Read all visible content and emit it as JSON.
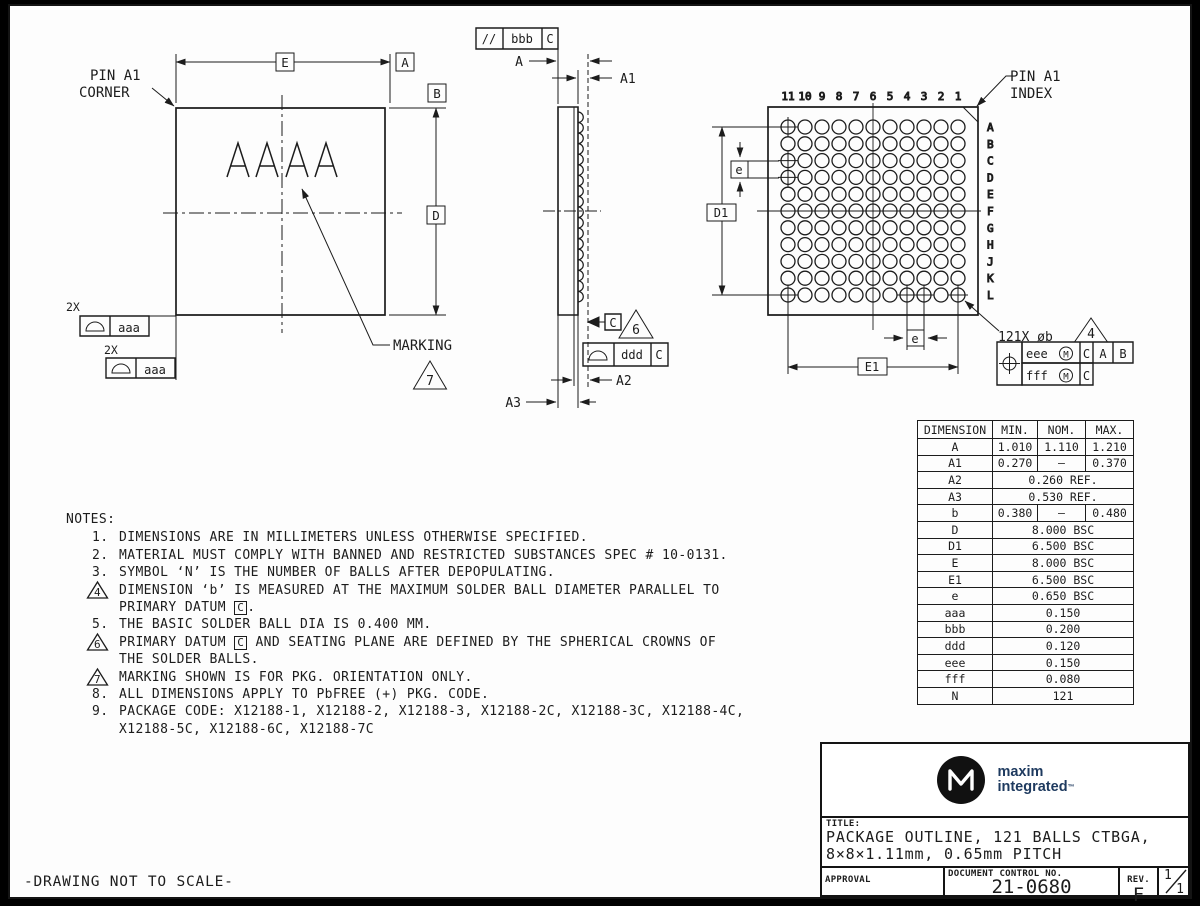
{
  "page": {
    "scale_note": "-DRAWING NOT TO SCALE-"
  },
  "colors": {
    "line": "#1c1c1c",
    "brand_navy": "#1e3a5f",
    "page_bg": "#fdfdfd",
    "frame_bg": "#000000"
  },
  "top_view": {
    "pin_a1_corner_line1": "PIN A1",
    "pin_a1_corner_line2": "CORNER",
    "marking_text": "AAAA",
    "marking_label": "MARKING",
    "marking_flag": "7",
    "dim_e_label": "E",
    "datum_a": "A",
    "datum_b": "B",
    "dim_d_label": "D",
    "qty_label_1": "2X",
    "qty_label_2": "2X",
    "profile_tolerance_1": "aaa",
    "profile_tolerance_2": "aaa"
  },
  "side_view": {
    "parallelism_frame": {
      "symbol": "//",
      "tolerance": "bbb",
      "datum": "C"
    },
    "dim_a": "A",
    "dim_a1": "A1",
    "dim_a2": "A2",
    "dim_a3": "A3",
    "seating_datum": "C",
    "seating_flag": "6",
    "profile_frame": {
      "tolerance": "ddd",
      "datum": "C"
    }
  },
  "bottom_view": {
    "pin_a1_index_line1": "PIN A1",
    "pin_a1_index_line2": "INDEX",
    "column_labels": [
      "11",
      "10",
      "9",
      "8",
      "7",
      "6",
      "5",
      "4",
      "3",
      "2",
      "1"
    ],
    "row_labels": [
      "A",
      "B",
      "C",
      "D",
      "E",
      "F",
      "G",
      "H",
      "J",
      "K",
      "L"
    ],
    "crosshair_balls": [
      "A-11",
      "C-11",
      "D-11",
      "L-11",
      "L-4",
      "L-3",
      "L-1"
    ],
    "dim_d1_label": "D1",
    "dim_e1_label": "E1",
    "pitch_label_left": "e",
    "pitch_label_bottom": "e",
    "ball_callout": "121X øb",
    "ball_flag": "4",
    "position_frame": {
      "row1": {
        "tolerance": "eee",
        "modifier": "M",
        "datum1": "C",
        "datum2": "A",
        "datum3": "B"
      },
      "row2": {
        "tolerance": "fff",
        "modifier": "M",
        "datum1": "C"
      }
    }
  },
  "notes": {
    "heading": "NOTES:",
    "items": [
      {
        "num": "1.",
        "text": "DIMENSIONS ARE IN MILLIMETERS UNLESS OTHERWISE SPECIFIED."
      },
      {
        "num": "2.",
        "text": "MATERIAL MUST COMPLY WITH BANNED AND RESTRICTED SUBSTANCES SPEC # 10-0131."
      },
      {
        "num": "3.",
        "text": "SYMBOL ‘N’ IS THE NUMBER OF BALLS AFTER DEPOPULATING."
      },
      {
        "flag": "4",
        "text": "DIMENSION ‘b’ IS MEASURED AT THE MAXIMUM SOLDER BALL DIAMETER PARALLEL TO\nPRIMARY DATUM [C]."
      },
      {
        "num": "5.",
        "text": "THE BASIC SOLDER BALL DIA IS 0.400 MM."
      },
      {
        "flag": "6",
        "text": "PRIMARY DATUM [C] AND SEATING PLANE ARE DEFINED BY THE SPHERICAL CROWNS OF\nTHE SOLDER BALLS."
      },
      {
        "flag": "7",
        "text": "MARKING SHOWN IS FOR PKG. ORIENTATION ONLY."
      },
      {
        "num": "8.",
        "text": "ALL DIMENSIONS APPLY TO PbFREE (+) PKG. CODE."
      },
      {
        "num": "9.",
        "text": "PACKAGE CODE: X12188-1, X12188-2, X12188-3, X12188-2C, X12188-3C, X12188-4C,\nX12188-5C, X12188-6C, X12188-7C"
      }
    ]
  },
  "dimension_table": {
    "headers": [
      "DIMENSION",
      "MIN.",
      "NOM.",
      "MAX."
    ],
    "rows": [
      {
        "dim": "A",
        "min": "1.010",
        "nom": "1.110",
        "max": "1.210"
      },
      {
        "dim": "A1",
        "min": "0.270",
        "nom": "–",
        "max": "0.370"
      },
      {
        "dim": "A2",
        "span": "0.260 REF."
      },
      {
        "dim": "A3",
        "span": "0.530 REF."
      },
      {
        "dim": "b",
        "min": "0.380",
        "nom": "–",
        "max": "0.480"
      },
      {
        "dim": "D",
        "span": "8.000 BSC"
      },
      {
        "dim": "D1",
        "span": "6.500 BSC"
      },
      {
        "dim": "E",
        "span": "8.000 BSC"
      },
      {
        "dim": "E1",
        "span": "6.500 BSC"
      },
      {
        "dim": "e",
        "span": "0.650 BSC"
      },
      {
        "dim": "aaa",
        "span": "0.150"
      },
      {
        "dim": "bbb",
        "span": "0.200"
      },
      {
        "dim": "ddd",
        "span": "0.120"
      },
      {
        "dim": "eee",
        "span": "0.150"
      },
      {
        "dim": "fff",
        "span": "0.080"
      },
      {
        "dim": "N",
        "span": "121"
      }
    ]
  },
  "title_block": {
    "brand_line1": "maxim",
    "brand_line2": "integrated",
    "brand_tm": "™",
    "title_label": "TITLE:",
    "title_line1": "PACKAGE OUTLINE, 121 BALLS CTBGA,",
    "title_line2": "8×8×1.11mm, 0.65mm PITCH",
    "approval_label": "APPROVAL",
    "doc_no_label": "DOCUMENT CONTROL NO.",
    "doc_no": "21-0680",
    "rev_label": "REV.",
    "rev": "F",
    "sheet_num": "1",
    "sheet_total": "1"
  }
}
